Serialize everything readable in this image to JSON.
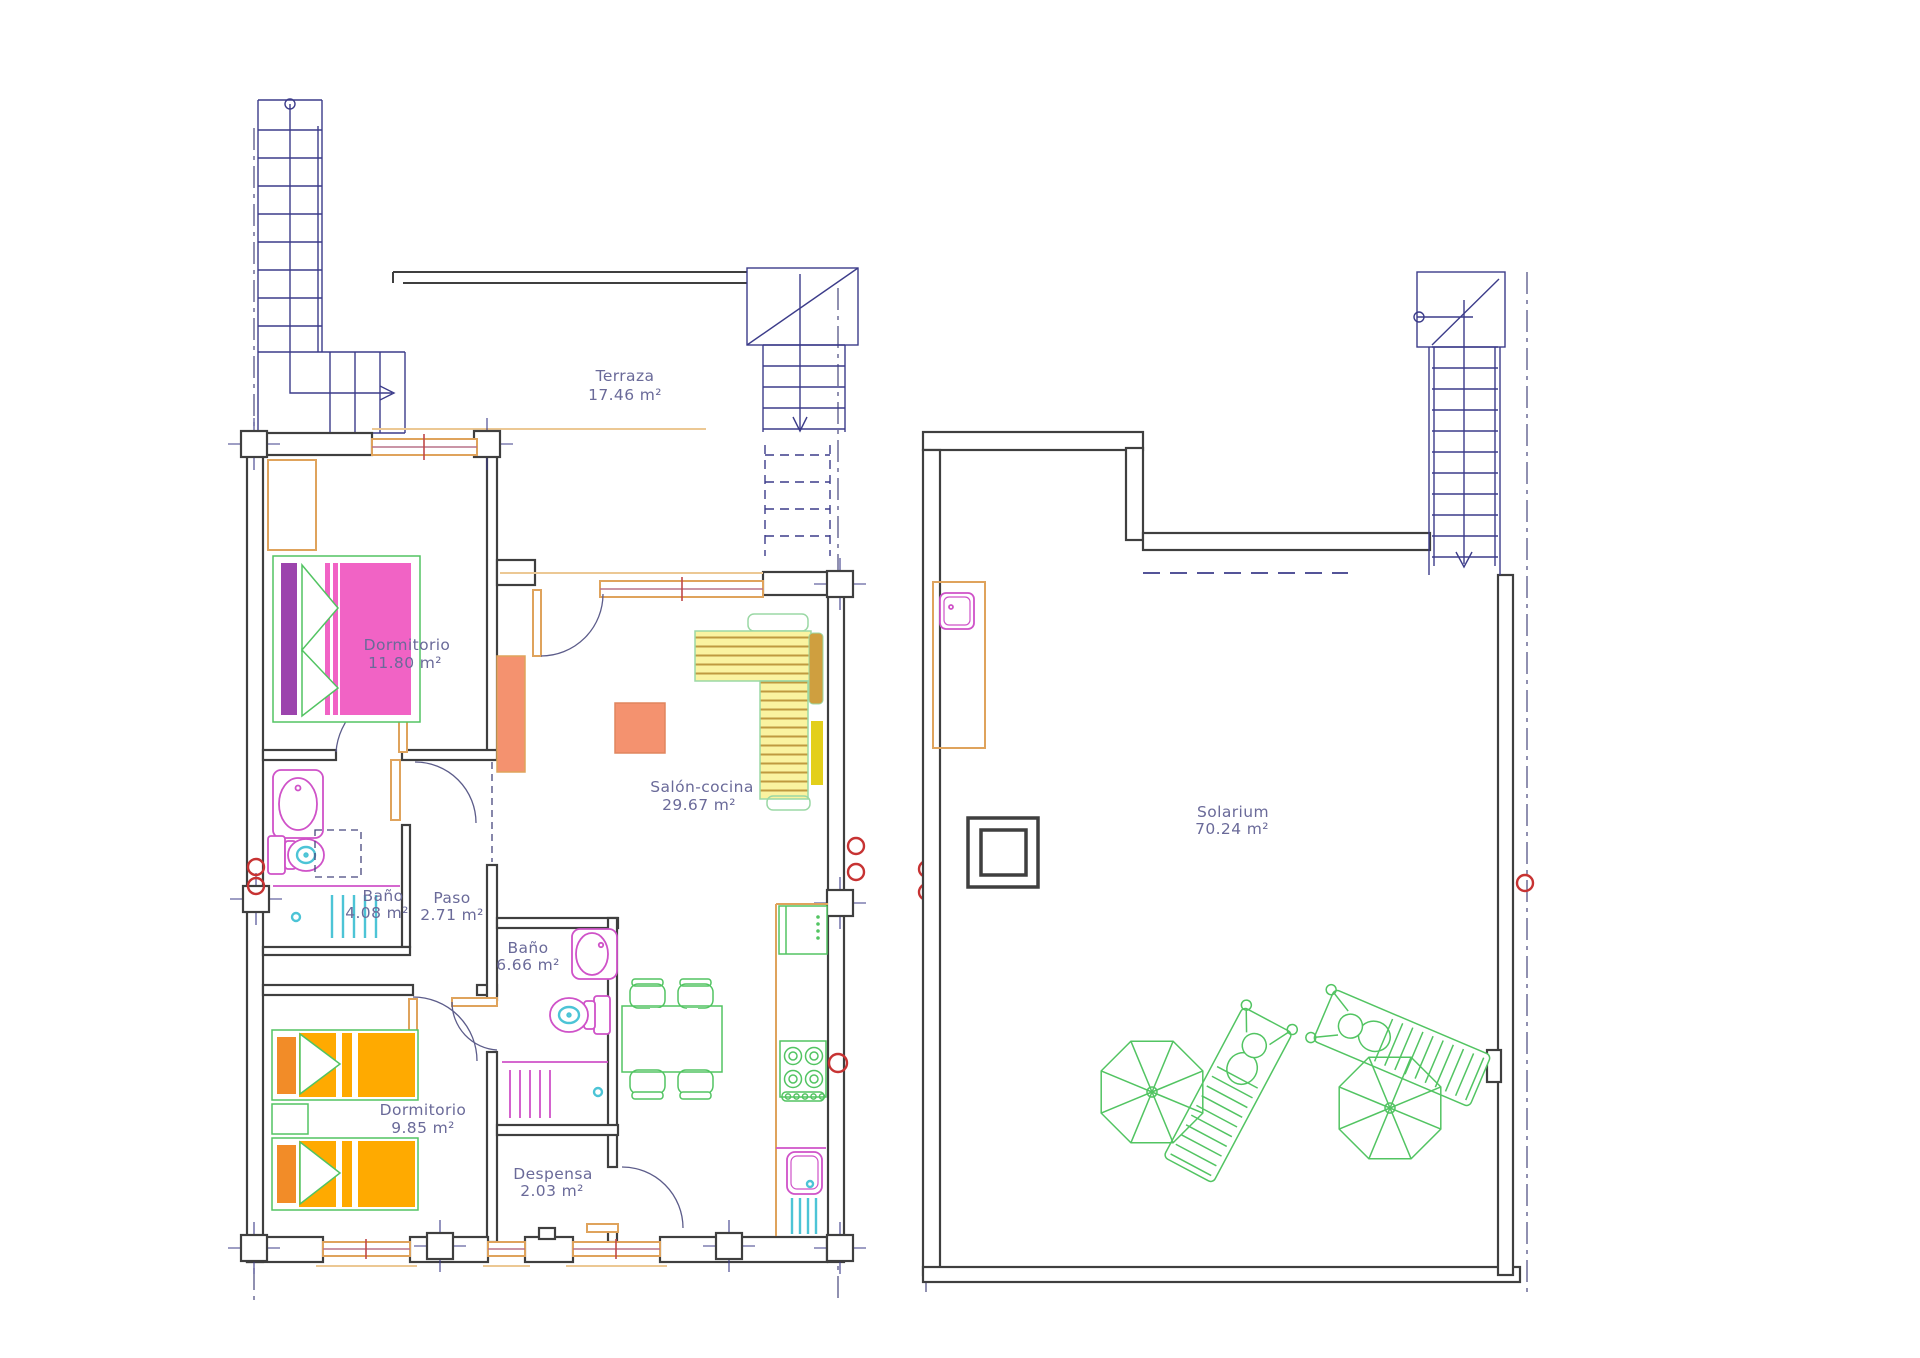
{
  "document": {
    "type": "floor-plan",
    "units_shown": 2
  },
  "colors": {
    "wall": "#3f3f3f",
    "stair_blue": "#3c3c8a",
    "axis_blue": "#46467d",
    "label_text": "#6a6a99",
    "window_orange": "#dfa35c",
    "fixture_magenta": "#cf52c8",
    "fixture_cyan": "#4cc4d6",
    "furniture_green": "#52c462",
    "bed_pink": "#f163c5",
    "bed_purple": "#9c44ad",
    "bed_orange": "#ffaa00",
    "table_salmon": "#f4926f",
    "sofa_yellow": "#faf3a0",
    "marker_red": "#c73333"
  },
  "rooms": [
    {
      "id": "terraza",
      "name": "Terraza",
      "area": "17.46 m²"
    },
    {
      "id": "dormitorio-1",
      "name": "Dormitorio",
      "area": "11.80 m²"
    },
    {
      "id": "salon-cocina",
      "name": "Salón-cocina",
      "area": "29.67 m²"
    },
    {
      "id": "bano-1",
      "name": "Baño",
      "area": "4.08 m²"
    },
    {
      "id": "paso",
      "name": "Paso",
      "area": "2.71 m²"
    },
    {
      "id": "bano-2",
      "name": "Baño",
      "area": "6.66 m²"
    },
    {
      "id": "dormitorio-2",
      "name": "Dormitorio",
      "area": "9.85 m²"
    },
    {
      "id": "despensa",
      "name": "Despensa",
      "area": "2.03 m²"
    },
    {
      "id": "solarium",
      "name": "Solarium",
      "area": "70.24 m²"
    }
  ]
}
